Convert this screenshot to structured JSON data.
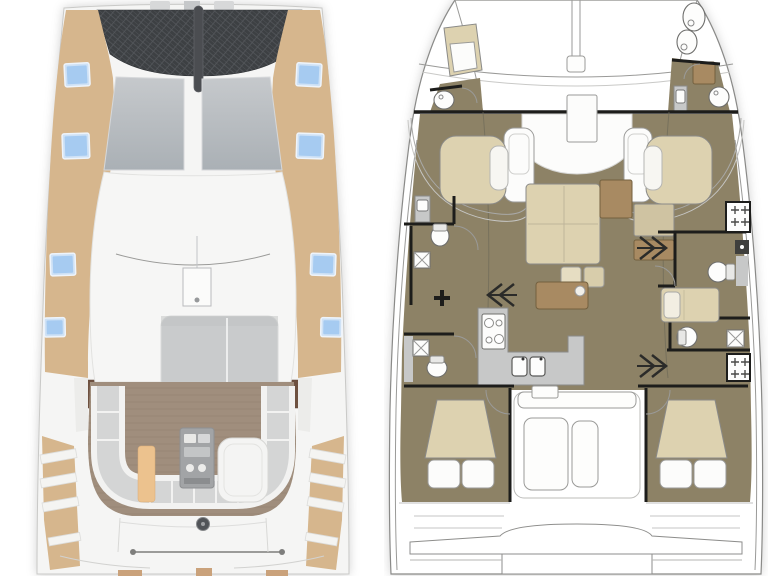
{
  "colors": {
    "deck_tan": "#d6b68d",
    "hatch_blue": "#a6cbf1",
    "trampoline_dark": "#3d4043",
    "hull_white": "#f5f5f4",
    "windshield_gray": "#b9bcc0",
    "sunpad_gray": "#c9cbcc",
    "cockpit_wood": "#a08e7d",
    "cushion_gray": "#d4d5d5",
    "accent_cushion_tan": "#ecc28e",
    "floor_khaki": "#8d8266",
    "furniture_beige": "#ddd2b0",
    "furniture_brown": "#a88a62",
    "counter_gray": "#c7c8c8",
    "wall_black": "#1d1d1b",
    "line_gray": "#9a9a98"
  },
  "left_panel": {
    "name": "exterior-deck-plan",
    "features": [
      "bow-trampoline",
      "anchor-chain",
      "side-decks",
      "deck-hatches",
      "windshield-panes",
      "coachroof",
      "traveler-track",
      "mast-step",
      "sunpads",
      "cockpit-wood-floor",
      "u-shaped-seating",
      "accent-cushion",
      "wet-bar",
      "cockpit-table",
      "side-steps",
      "stern-crossbar",
      "transom-steps"
    ]
  },
  "right_panel": {
    "name": "interior-floor-plan",
    "features": [
      "trampoline-beams",
      "bowsprit",
      "forepeak-heads",
      "forward-bulkhead",
      "forward-cockpit-table",
      "helm-seats",
      "forward-lounge-seats",
      "saloon-sofa",
      "dining-table",
      "coffee-table",
      "ottomans",
      "galley-counter",
      "stove",
      "double-sink",
      "companionway-stairs-port",
      "companionway-stairs-starboard",
      "port-bathrooms",
      "starboard-bathrooms",
      "toilets",
      "showers",
      "lockers",
      "mid-cabin-bed",
      "aft-cabin-beds",
      "pillows",
      "aft-cockpit-bench",
      "aft-cockpit-tables",
      "swim-platform"
    ]
  }
}
